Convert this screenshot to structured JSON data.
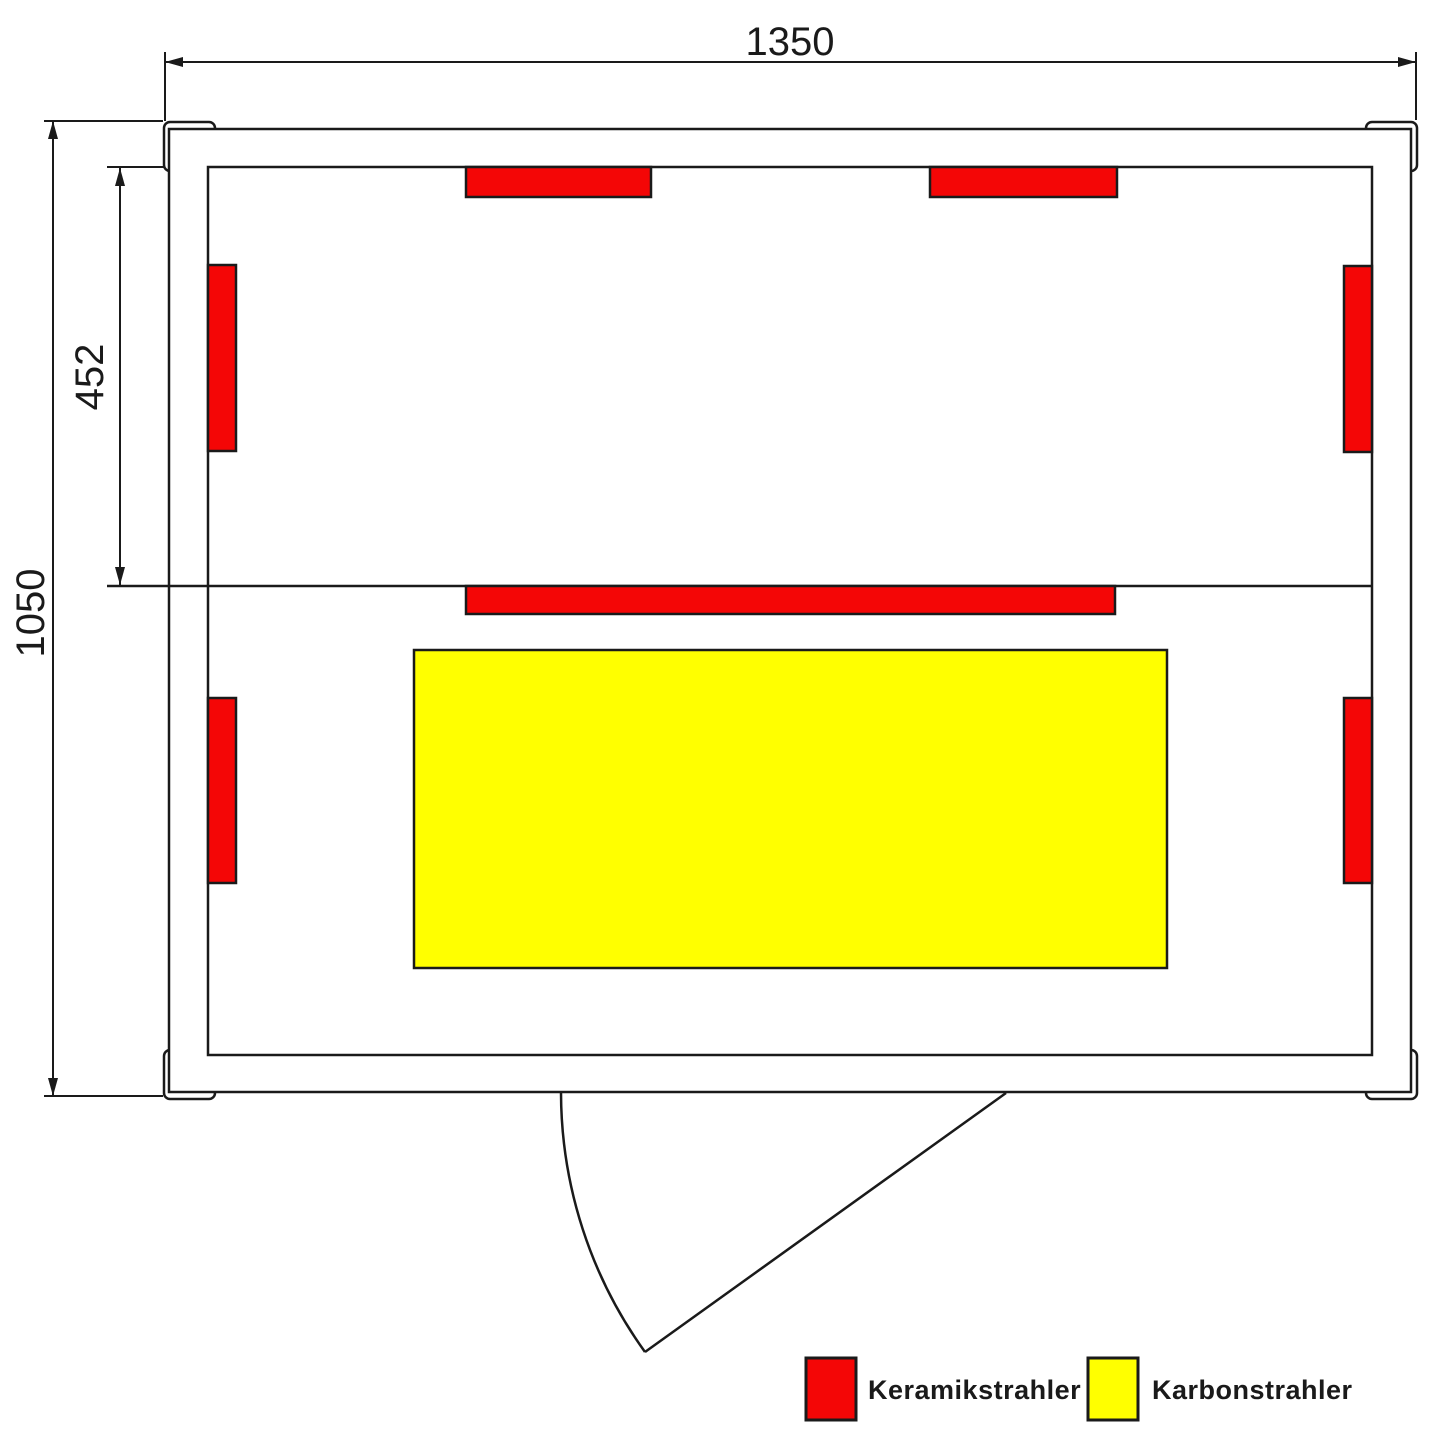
{
  "diagram": {
    "title": "Infrared sauna floor plan",
    "type": "floor-plan",
    "dimensions": {
      "width": {
        "label": "1350"
      },
      "height": {
        "label": "1050"
      },
      "bench_depth": {
        "label": "452"
      }
    },
    "legend": {
      "items": [
        {
          "id": "keramikstrahler",
          "label": "Keramikstrahler",
          "color": "#f40606"
        },
        {
          "id": "karbonstrahler",
          "label": "Karbonstrahler",
          "color": "#ffff00"
        }
      ]
    },
    "heaters": {
      "ceramic_count": 7,
      "carbon_count": 1
    },
    "colors": {
      "line": "#1a1a1a",
      "background": "#ffffff"
    }
  }
}
